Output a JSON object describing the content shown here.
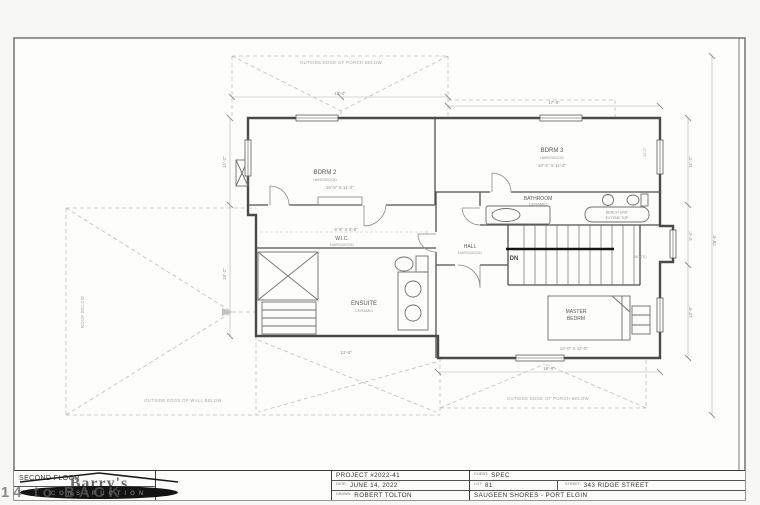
{
  "title_block": {
    "floor": {
      "title": "SECOND FLOOR",
      "area": "961 SQ. FT. (89.3 SQ.M.)"
    },
    "logo": {
      "name": "Barry's",
      "sub": "CONSTRUCTION"
    },
    "project": {
      "number": "PROJECT #2022-41",
      "date_label": "DATE:",
      "date": "JUNE 14, 2022",
      "drawn_label": "DRAWN:",
      "drawn": "ROBERT TOLTON"
    },
    "site": {
      "client_label": "CLIENT:",
      "client": "SPEC",
      "lot_label": "LOT:",
      "lot": "81",
      "street_label": "STREET:",
      "street": "343 RIDGE STREET",
      "city": "SAUGEEN SHORES - PORT ELGIN"
    }
  },
  "watermark": "B14 to BACK",
  "plan": {
    "rooms": {
      "bdrm2": {
        "name": "BDRM 2",
        "floor": "HARDWOOD",
        "dim": "16'-8\" X 11'-2\""
      },
      "bdrm3": {
        "name": "BDRM 3",
        "floor": "HARDWOOD",
        "dim": "10'-4\" X 11'-2\""
      },
      "bathroom": {
        "name": "BATHROOM",
        "floor": "CERAMIC"
      },
      "wic": {
        "name": "W.I.C.",
        "floor": "HARDWOOD",
        "dim": "9'-8\" X 3'-8\""
      },
      "ensuite": {
        "name": "ENSUITE",
        "floor": "CERAMIC"
      },
      "hall": {
        "name": "HALL",
        "floor": "HARDWOOD"
      },
      "master": {
        "name": "MASTER",
        "name2": "BEDRM",
        "dim": "13'-0\" X 12'-0\""
      },
      "stairs": {
        "dn": "DN"
      }
    },
    "notes": {
      "top": "OUTSIDE EDGE OF PORCH BELOW",
      "bottom_left": "OUTSIDE EDGE OF WALL BELOW",
      "bottom_right": "OUTSIDE EDGE OF PORCH BELOW",
      "roof_left": "ROOF BELOW",
      "capsule1": "BENCH UNIT",
      "capsule2": "EXTEND TOP",
      "note": "(NOTE)"
    },
    "dims": {
      "top": "18'-0\"",
      "top_right": "17'-8\"",
      "right_upper": "11'-2\"",
      "right_mid": "5'-4\"",
      "right_lower": "12'-0\"",
      "right_overall": "28'-6\"",
      "left_upper": "11'-2\"",
      "left_lower": "10'-2\"",
      "bottom_master": "18'-6\"",
      "bottom_ensuite": "13'-0\"",
      "bdrm3_side": "11'-2\""
    }
  },
  "colors": {
    "wall": "#4a4a4a",
    "dashed": "#bdbdbd",
    "banner": "#111111"
  }
}
